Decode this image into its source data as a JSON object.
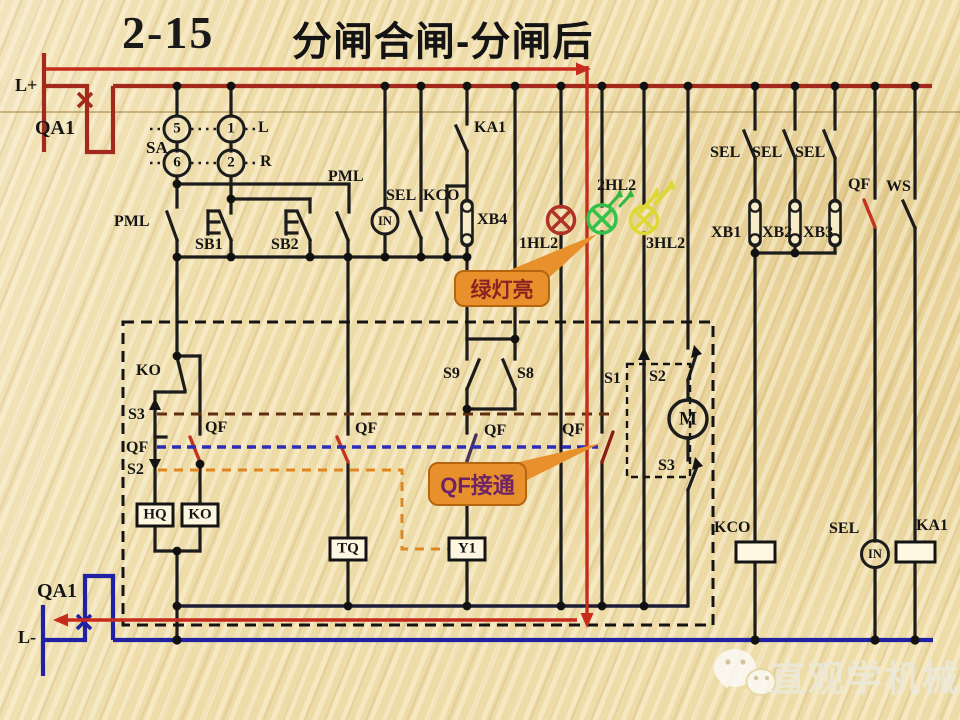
{
  "title": {
    "number": "2-15",
    "text": "分闸合闸-分闸后"
  },
  "power": {
    "top_terminal": "L+",
    "top_breaker": "QA1",
    "bottom_breaker": "QA1",
    "bottom_terminal": "L-"
  },
  "selector": {
    "label": "SA",
    "contact_5": "5",
    "contact_1": "1",
    "contact_6": "6",
    "contact_2": "2",
    "left_pos": "L",
    "right_pos": "R"
  },
  "labels": {
    "pml_left": "PML",
    "sb1": "SB1",
    "sb2": "SB2",
    "pml_mid": "PML",
    "sel_top": "SEL",
    "kco_top": "KCO",
    "in_top": "IN",
    "ka1_top": "KA1",
    "xb4": "XB4",
    "hl2_1": "1HL2",
    "hl2_2": "2HL2",
    "hl2_3": "3HL2",
    "sel_r1": "SEL",
    "sel_r2": "SEL",
    "sel_r3": "SEL",
    "xb1": "XB1",
    "xb2": "XB2",
    "xb3": "XB3",
    "qf_right": "QF",
    "ws": "WS",
    "ko_contact": "KO",
    "s3_left": "S3",
    "qf_left": "QF",
    "s2_left": "S2",
    "qf_ko": "QF",
    "hq_box": "HQ",
    "ko_box": "KO",
    "qf_tq": "QF",
    "tq_box": "TQ",
    "s9": "S9",
    "s8": "S8",
    "qf_y1": "QF",
    "y1_box": "Y1",
    "s1": "S1",
    "s2_mid": "S2",
    "m_motor": "M",
    "s3_mid": "S3",
    "qf_lamp": "QF",
    "kco_coil": "KCO",
    "sel_bottom": "SEL",
    "in_bottom": "IN",
    "ka1_coil": "KA1"
  },
  "callouts": {
    "green_lamp": "绿灯亮",
    "qf_closed": "QF接通"
  },
  "watermark": {
    "text": "直观学机械",
    "icon": "wechat-icon"
  },
  "colors": {
    "background": "#eedca8",
    "bus_top_red": "#a3291c",
    "flow_red": "#c62b1c",
    "bus_bottom_blue": "#2121a3",
    "wire_black": "#1c1c1c",
    "return_rail": "#1c1c38",
    "s3_link_dash": "#5f2d10",
    "qf_link_dash": "#2c2cb8",
    "s2_link_dash": "#dd8722",
    "callout_orange": "#e8912c",
    "lamp_red": "#b03328",
    "lamp_green": "#35c24a",
    "lamp_yellow": "#ddd835",
    "callout_text_green": "#8b2323",
    "callout_text_qf": "#6e2366"
  }
}
